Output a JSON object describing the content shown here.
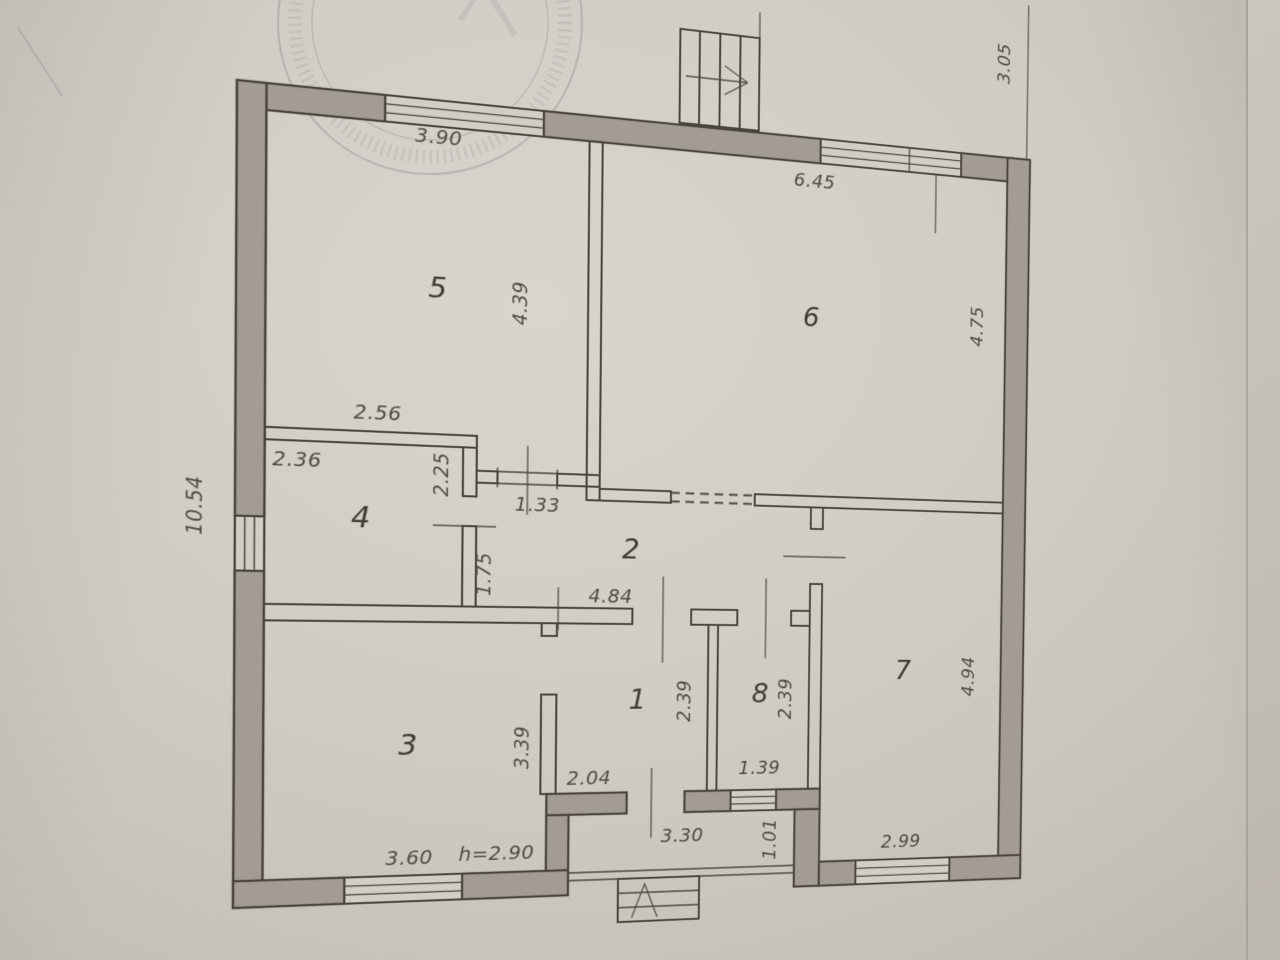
{
  "plan": {
    "rooms": [
      {
        "number": "1",
        "dims": {
          "width": "2.04",
          "depth": "2.39"
        }
      },
      {
        "number": "2",
        "dims": {
          "length": "4.84",
          "width": "1.75",
          "door_width": "1.33"
        }
      },
      {
        "number": "3",
        "dims": {
          "width": "3.60",
          "depth": "3.39"
        }
      },
      {
        "number": "4",
        "dims": {
          "width": "2.36",
          "depth": "2.25",
          "wall_top": "2.56"
        }
      },
      {
        "number": "5",
        "dims": {
          "window": "3.90",
          "depth": "4.39"
        }
      },
      {
        "number": "6",
        "dims": {
          "window": "6.45",
          "depth": "4.75"
        }
      },
      {
        "number": "7",
        "dims": {
          "window": "2.99",
          "depth": "4.94"
        }
      },
      {
        "number": "8",
        "dims": {
          "width": "1.39",
          "depth": "2.39"
        }
      }
    ],
    "exterior": {
      "side_total": "10.54",
      "top_offset": "3.05",
      "ceiling_height": "h=2.90",
      "entry_width": "3.30",
      "entry_wall": "1.01"
    }
  },
  "colors": {
    "paper": "#cecac2",
    "paper2": "#d4d0c8",
    "wall": "#a49d93",
    "line": "#46413b",
    "ink": "#4e4841",
    "ink2": "#3e3933"
  }
}
